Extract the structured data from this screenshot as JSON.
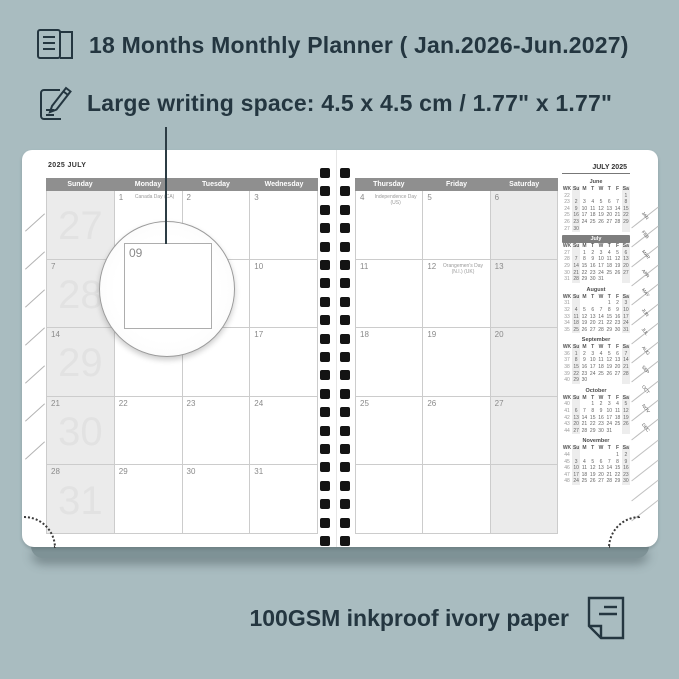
{
  "colors": {
    "background": "#a9bcc0",
    "ink": "#243640",
    "page": "#ffffff",
    "header_bar": "#8f8f8f",
    "shaded_column": "#ebebeb",
    "mini_highlight_bar": "#7e7e7e",
    "spiral_hole": "#141414"
  },
  "icons": {
    "feature1": "open-book-icon",
    "feature2": "pencil-note-icon",
    "footer": "paper-sheet-icon"
  },
  "features": {
    "months": "18 Months Monthly Planner ( Jan.2026-Jun.2027)",
    "writing_space": "Large writing space: 4.5 x 4.5 cm / 1.77\" x 1.77\""
  },
  "footer": {
    "text": "100GSM inkproof ivory paper"
  },
  "magnifier": {
    "label": "09"
  },
  "planner": {
    "left_page": {
      "title": "2025 JULY",
      "day_headers": [
        "Sunday",
        "Monday",
        "Tuesday",
        "Wednesday"
      ],
      "rows": [
        [
          {
            "wk": "27",
            "d": ""
          },
          {
            "d": "1",
            "h": "Canada Day (CA)"
          },
          {
            "d": "2"
          },
          {
            "d": "3"
          }
        ],
        [
          {
            "wk": "28",
            "d": "7"
          },
          {
            "d": "8"
          },
          {
            "d": "9"
          },
          {
            "d": "10"
          }
        ],
        [
          {
            "wk": "29",
            "d": "14"
          },
          {
            "d": "15"
          },
          {
            "d": "16"
          },
          {
            "d": "17"
          }
        ],
        [
          {
            "wk": "30",
            "d": "21"
          },
          {
            "d": "22"
          },
          {
            "d": "23"
          },
          {
            "d": "24"
          }
        ],
        [
          {
            "wk": "31",
            "d": "28"
          },
          {
            "d": "29"
          },
          {
            "d": "30"
          },
          {
            "d": "31"
          }
        ]
      ]
    },
    "right_page": {
      "day_headers": [
        "Thursday",
        "Friday",
        "Saturday"
      ],
      "rows": [
        [
          {
            "d": "4",
            "h": "Independence Day (US)"
          },
          {
            "d": "5"
          },
          {
            "d": "6"
          }
        ],
        [
          {
            "d": "11"
          },
          {
            "d": "12",
            "h": "Orangemen's Day (N.I.) (UK)"
          },
          {
            "d": "13"
          }
        ],
        [
          {
            "d": "18"
          },
          {
            "d": "19"
          },
          {
            "d": "20"
          }
        ],
        [
          {
            "d": "25"
          },
          {
            "d": "26"
          },
          {
            "d": "27"
          }
        ],
        [
          {
            "d": ""
          },
          {
            "d": ""
          },
          {
            "d": ""
          }
        ]
      ]
    },
    "sidebar": {
      "title": "JULY 2025",
      "weekday_headers": [
        "WK",
        "Su",
        "M",
        "T",
        "W",
        "T",
        "F",
        "Sa"
      ],
      "months": [
        {
          "name": "June",
          "highlight": false,
          "rows": [
            [
              "22",
              "",
              "",
              "",
              "",
              "",
              "",
              "1"
            ],
            [
              "23",
              "2",
              "3",
              "4",
              "5",
              "6",
              "7",
              "8"
            ],
            [
              "24",
              "9",
              "10",
              "11",
              "12",
              "13",
              "14",
              "15"
            ],
            [
              "25",
              "16",
              "17",
              "18",
              "19",
              "20",
              "21",
              "22"
            ],
            [
              "26",
              "23",
              "24",
              "25",
              "26",
              "27",
              "28",
              "29"
            ],
            [
              "27",
              "30",
              "",
              "",
              "",
              "",
              "",
              ""
            ]
          ]
        },
        {
          "name": "July",
          "highlight": true,
          "rows": [
            [
              "27",
              "",
              "1",
              "2",
              "3",
              "4",
              "5",
              "6"
            ],
            [
              "28",
              "7",
              "8",
              "9",
              "10",
              "11",
              "12",
              "13"
            ],
            [
              "29",
              "14",
              "15",
              "16",
              "17",
              "18",
              "19",
              "20"
            ],
            [
              "30",
              "21",
              "22",
              "23",
              "24",
              "25",
              "26",
              "27"
            ],
            [
              "31",
              "28",
              "29",
              "30",
              "31",
              "",
              "",
              ""
            ]
          ]
        },
        {
          "name": "August",
          "highlight": false,
          "rows": [
            [
              "31",
              "",
              "",
              "",
              "",
              "1",
              "2",
              "3"
            ],
            [
              "32",
              "4",
              "5",
              "6",
              "7",
              "8",
              "9",
              "10"
            ],
            [
              "33",
              "11",
              "12",
              "13",
              "14",
              "15",
              "16",
              "17"
            ],
            [
              "34",
              "18",
              "19",
              "20",
              "21",
              "22",
              "23",
              "24"
            ],
            [
              "35",
              "25",
              "26",
              "27",
              "28",
              "29",
              "30",
              "31"
            ]
          ]
        },
        {
          "name": "September",
          "highlight": false,
          "rows": [
            [
              "36",
              "1",
              "2",
              "3",
              "4",
              "5",
              "6",
              "7"
            ],
            [
              "37",
              "8",
              "9",
              "10",
              "11",
              "12",
              "13",
              "14"
            ],
            [
              "38",
              "15",
              "16",
              "17",
              "18",
              "19",
              "20",
              "21"
            ],
            [
              "39",
              "22",
              "23",
              "24",
              "25",
              "26",
              "27",
              "28"
            ],
            [
              "40",
              "29",
              "30",
              "",
              "",
              "",
              "",
              ""
            ]
          ]
        },
        {
          "name": "October",
          "highlight": false,
          "rows": [
            [
              "40",
              "",
              "",
              "1",
              "2",
              "3",
              "4",
              "5"
            ],
            [
              "41",
              "6",
              "7",
              "8",
              "9",
              "10",
              "11",
              "12"
            ],
            [
              "42",
              "13",
              "14",
              "15",
              "16",
              "17",
              "18",
              "19"
            ],
            [
              "43",
              "20",
              "21",
              "22",
              "23",
              "24",
              "25",
              "26"
            ],
            [
              "44",
              "27",
              "28",
              "29",
              "30",
              "31",
              "",
              ""
            ]
          ]
        },
        {
          "name": "November",
          "highlight": false,
          "rows": [
            [
              "44",
              "",
              "",
              "",
              "",
              "",
              "1",
              "2"
            ],
            [
              "45",
              "3",
              "4",
              "5",
              "6",
              "7",
              "8",
              "9"
            ],
            [
              "46",
              "10",
              "11",
              "12",
              "13",
              "14",
              "15",
              "16"
            ],
            [
              "47",
              "17",
              "18",
              "19",
              "20",
              "21",
              "22",
              "23"
            ],
            [
              "48",
              "24",
              "25",
              "26",
              "27",
              "28",
              "29",
              "30"
            ]
          ]
        }
      ]
    },
    "month_tabs": [
      "JAN",
      "FEB",
      "MAR",
      "APR",
      "MAY",
      "JUN",
      "JUL",
      "AUG",
      "SEP",
      "OCT",
      "NOV",
      "DEC"
    ]
  }
}
